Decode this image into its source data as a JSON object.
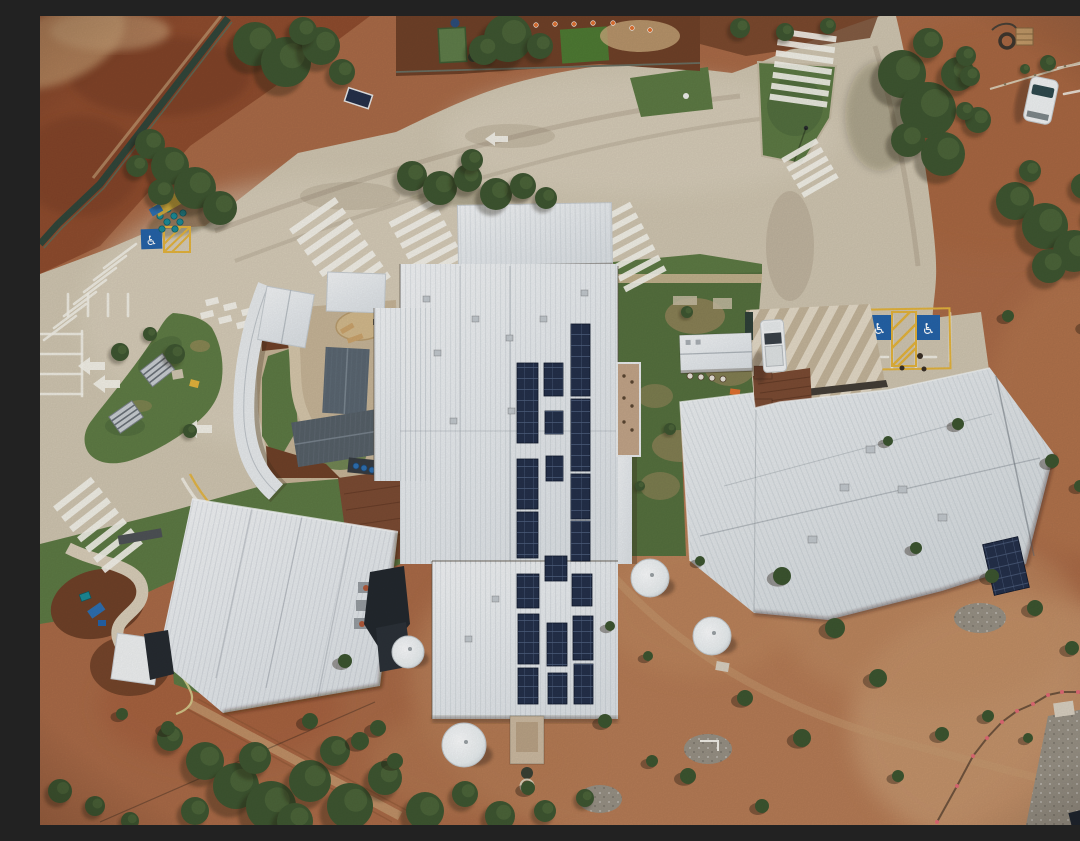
{
  "meta": {
    "alt": "Aerial top-down drone photo of a remote outback school campus: white corrugated metal roofs with rooftop solar panel arrays, a looped car park with a grass island and shade shelters, zebra crossings, accessible parking bays, water tanks, scattered trees and shrubs on red dirt ground"
  },
  "colors": {
    "dirt_base": "#a96a47",
    "dirt_dark": "#8e4c2e",
    "dirt_deep": "#7c3f25",
    "dirt_light": "#bf8a62",
    "dirt_pale": "#c89a72",
    "concrete": "#cfc5b0",
    "concrete_light": "#dbd2bf",
    "concrete_dark": "#b7ab94",
    "roof_white": "#e9ecee",
    "roof_gray": "#5a6671",
    "solar": "#24304a",
    "solar_line": "#43567a",
    "grass": "#5d7a44",
    "grass_dark": "#49633a",
    "courtyard": "#55703e",
    "courtyard_patch": "#96855b",
    "tree": "#3e5631",
    "tree_light": "#55713f",
    "mulch": "#6f4128",
    "white": "#f4f4f2",
    "yellow": "#e3b33c",
    "sign_blue": "#2563a8",
    "teal": "#1c8a96",
    "tank": "#eff2f3",
    "shadow": "#2a1c12",
    "dark_structure": "#262b31",
    "rust": "#7b4b33",
    "walk_dark": "#443e37",
    "gravel": "#979084",
    "path_tan": "#c6b497",
    "terrace": "#c3b49a",
    "car_white": "#f0f2f3",
    "glass": "#3a4148",
    "cone_orange": "#e07030",
    "flag_pink": "#e06a74"
  },
  "scene": {
    "solar_panels": [
      [
        477,
        347,
        21,
        80
      ],
      [
        477,
        443,
        21,
        50
      ],
      [
        477,
        496,
        21,
        46
      ],
      [
        477,
        558,
        22,
        34
      ],
      [
        478,
        598,
        21,
        50
      ],
      [
        478,
        652,
        20,
        36
      ],
      [
        504,
        347,
        19,
        33
      ],
      [
        505,
        395,
        18,
        23
      ],
      [
        506,
        440,
        17,
        25
      ],
      [
        505,
        540,
        22,
        25
      ],
      [
        507,
        607,
        20,
        43
      ],
      [
        508,
        657,
        19,
        31
      ],
      [
        531,
        308,
        19,
        72
      ],
      [
        531,
        383,
        19,
        72
      ],
      [
        531,
        458,
        19,
        45
      ],
      [
        531,
        505,
        19,
        40
      ],
      [
        532,
        558,
        20,
        32
      ],
      [
        533,
        600,
        20,
        44
      ],
      [
        534,
        648,
        19,
        40
      ]
    ],
    "trees": [
      [
        215,
        28,
        22
      ],
      [
        246,
        46,
        25
      ],
      [
        281,
        30,
        19
      ],
      [
        302,
        56,
        13
      ],
      [
        263,
        15,
        14
      ],
      [
        110,
        128,
        15
      ],
      [
        130,
        150,
        19
      ],
      [
        155,
        172,
        21
      ],
      [
        180,
        192,
        17
      ],
      [
        121,
        176,
        13
      ],
      [
        97,
        150,
        11
      ],
      [
        372,
        160,
        15
      ],
      [
        400,
        172,
        17
      ],
      [
        428,
        162,
        14
      ],
      [
        456,
        178,
        16
      ],
      [
        483,
        170,
        13
      ],
      [
        506,
        182,
        11
      ],
      [
        432,
        144,
        11
      ],
      [
        468,
        22,
        24
      ],
      [
        444,
        34,
        15
      ],
      [
        500,
        30,
        13
      ],
      [
        862,
        58,
        24
      ],
      [
        888,
        94,
        28
      ],
      [
        903,
        138,
        22
      ],
      [
        868,
        124,
        17
      ],
      [
        918,
        58,
        17
      ],
      [
        888,
        27,
        15
      ],
      [
        938,
        104,
        13
      ],
      [
        926,
        40,
        10
      ],
      [
        975,
        185,
        19
      ],
      [
        1005,
        210,
        23
      ],
      [
        1034,
        235,
        21
      ],
      [
        1059,
        200,
        15
      ],
      [
        1009,
        250,
        17
      ],
      [
        1044,
        170,
        13
      ],
      [
        990,
        155,
        11
      ],
      [
        1062,
        10,
        13
      ],
      [
        1075,
        34,
        11
      ],
      [
        1008,
        47,
        8
      ],
      [
        985,
        53,
        5
      ],
      [
        930,
        60,
        10
      ],
      [
        925,
        95,
        9
      ],
      [
        165,
        745,
        19
      ],
      [
        196,
        770,
        23
      ],
      [
        231,
        790,
        25
      ],
      [
        270,
        765,
        21
      ],
      [
        310,
        790,
        23
      ],
      [
        345,
        762,
        17
      ],
      [
        385,
        795,
        19
      ],
      [
        425,
        778,
        13
      ],
      [
        460,
        800,
        15
      ],
      [
        130,
        722,
        13
      ],
      [
        295,
        735,
        15
      ],
      [
        505,
        795,
        11
      ],
      [
        545,
        782,
        9
      ],
      [
        215,
        742,
        16
      ],
      [
        255,
        805,
        18
      ],
      [
        155,
        795,
        14
      ],
      [
        80,
        336,
        9
      ],
      [
        135,
        338,
        10
      ],
      [
        110,
        318,
        7
      ],
      [
        150,
        415,
        7
      ],
      [
        647,
        296,
        6
      ],
      [
        630,
        413,
        6
      ],
      [
        600,
        470,
        5
      ],
      [
        20,
        775,
        12
      ],
      [
        55,
        790,
        10
      ],
      [
        90,
        805,
        9
      ],
      [
        700,
        12,
        10
      ],
      [
        745,
        16,
        9
      ],
      [
        788,
        10,
        8
      ]
    ],
    "shrubs": [
      [
        742,
        560,
        9
      ],
      [
        795,
        612,
        10
      ],
      [
        838,
        662,
        9
      ],
      [
        705,
        682,
        8
      ],
      [
        762,
        722,
        9
      ],
      [
        648,
        760,
        8
      ],
      [
        565,
        705,
        7
      ],
      [
        612,
        745,
        6
      ],
      [
        488,
        772,
        7
      ],
      [
        305,
        645,
        7
      ],
      [
        338,
        712,
        8
      ],
      [
        128,
        712,
        7
      ],
      [
        82,
        698,
        6
      ],
      [
        995,
        592,
        8
      ],
      [
        1032,
        632,
        7
      ],
      [
        952,
        560,
        7
      ],
      [
        876,
        532,
        6
      ],
      [
        1012,
        445,
        7
      ],
      [
        918,
        408,
        6
      ],
      [
        848,
        425,
        5
      ],
      [
        968,
        300,
        6
      ],
      [
        1048,
        310,
        7
      ],
      [
        1040,
        470,
        6
      ],
      [
        902,
        718,
        7
      ],
      [
        858,
        760,
        6
      ],
      [
        722,
        790,
        7
      ],
      [
        948,
        700,
        6
      ],
      [
        988,
        722,
        5
      ],
      [
        270,
        705,
        8
      ],
      [
        320,
        725,
        9
      ],
      [
        355,
        745,
        8
      ],
      [
        660,
        545,
        5
      ],
      [
        608,
        640,
        5
      ],
      [
        570,
        610,
        5
      ]
    ],
    "zebras": [
      {
        "x": 300,
        "y": 237,
        "a": -35,
        "n": 8,
        "len": 56,
        "t": 6.5,
        "g": 13
      },
      {
        "x": 58,
        "y": 509,
        "a": -38,
        "n": 7,
        "len": 48,
        "t": 6.5,
        "g": 13
      },
      {
        "x": 389,
        "y": 229,
        "a": -28,
        "n": 7,
        "len": 50,
        "t": 6,
        "g": 12
      },
      {
        "x": 588,
        "y": 231,
        "a": -28,
        "n": 7,
        "len": 46,
        "t": 6,
        "g": 12
      },
      {
        "x": 763,
        "y": 52,
        "a": 8,
        "n": 7,
        "len": 58,
        "t": 6,
        "g": 11
      },
      {
        "x": 770,
        "y": 152,
        "a": -30,
        "n": 5,
        "len": 40,
        "t": 5.5,
        "g": 10
      }
    ],
    "white_lines": [
      [
        96,
        228,
        64,
        252
      ],
      [
        86,
        240,
        54,
        264
      ],
      [
        76,
        252,
        44,
        276
      ],
      [
        66,
        264,
        34,
        288
      ],
      [
        56,
        276,
        24,
        300
      ],
      [
        46,
        288,
        14,
        312
      ],
      [
        36,
        300,
        4,
        324
      ],
      [
        28,
        278,
        28,
        300
      ],
      [
        48,
        278,
        48,
        300
      ],
      [
        68,
        278,
        68,
        300
      ],
      [
        88,
        278,
        88,
        300
      ],
      [
        0,
        318,
        42,
        318
      ],
      [
        0,
        338,
        42,
        338
      ],
      [
        0,
        358,
        42,
        358
      ],
      [
        0,
        378,
        42,
        378
      ],
      [
        42,
        315,
        42,
        380
      ],
      [
        852,
        300,
        852,
        352
      ],
      [
        876,
        300,
        876,
        352
      ],
      [
        910,
        297,
        910,
        345
      ],
      [
        834,
        341,
        848,
        341
      ],
      [
        882,
        341,
        896,
        341
      ],
      [
        1018,
        52,
        1048,
        46
      ],
      [
        1024,
        78,
        1054,
        72
      ]
    ],
    "arrows": [
      "65,346 50,346 50,341 38,350 50,359 50,354 65,354",
      "80,364 65,364 65,359 53,368 65,377 65,372 80,372",
      "172,409 157,409 157,404 145,413 157,422 157,417 172,417",
      "468,120 455,120 455,116 445,123 455,130 455,126 468,126"
    ],
    "crossing_blocks": [
      [
        165,
        284
      ],
      [
        183,
        289
      ],
      [
        201,
        294
      ],
      [
        219,
        299
      ],
      [
        237,
        304
      ],
      [
        160,
        297
      ],
      [
        178,
        302
      ],
      [
        196,
        307
      ],
      [
        214,
        312
      ],
      [
        232,
        317
      ]
    ],
    "cones": [
      [
        496,
        9
      ],
      [
        515,
        8
      ],
      [
        534,
        8
      ],
      [
        553,
        7
      ],
      [
        573,
        7
      ],
      [
        592,
        12
      ],
      [
        610,
        14
      ],
      [
        466,
        12
      ]
    ],
    "flags": [
      [
        897,
        806
      ],
      [
        917,
        770
      ],
      [
        933,
        740
      ],
      [
        947,
        722
      ],
      [
        962,
        706
      ],
      [
        977,
        695
      ],
      [
        993,
        688
      ],
      [
        1008,
        679
      ],
      [
        1022,
        676
      ],
      [
        1038,
        676
      ],
      [
        1058,
        680
      ],
      [
        1076,
        684
      ]
    ],
    "vents_central": [
      [
        383,
        280
      ],
      [
        432,
        300
      ],
      [
        466,
        319
      ],
      [
        394,
        334
      ],
      [
        410,
        402
      ],
      [
        468,
        392
      ],
      [
        541,
        274
      ],
      [
        452,
        580
      ],
      [
        425,
        620
      ],
      [
        500,
        300
      ]
    ],
    "vents_right": [
      [
        826,
        430
      ],
      [
        858,
        470
      ],
      [
        898,
        498
      ],
      [
        768,
        520
      ],
      [
        800,
        468
      ]
    ],
    "tanks": [
      [
        610,
        562,
        19
      ],
      [
        672,
        620,
        19
      ],
      [
        424,
        729,
        22
      ],
      [
        368,
        636,
        16
      ]
    ],
    "gravel": [
      [
        560,
        783,
        22,
        14
      ],
      [
        668,
        733,
        24,
        15
      ],
      [
        940,
        602,
        26,
        15
      ]
    ],
    "tables": [
      [
        650,
        360
      ],
      [
        661,
        361
      ],
      [
        672,
        362
      ],
      [
        683,
        363
      ]
    ],
    "pads": [
      [
        633,
        280,
        24,
        9
      ],
      [
        673,
        282,
        19,
        11
      ]
    ],
    "bins_teal": [
      [
        120,
        200
      ],
      [
        127,
        206
      ],
      [
        134,
        200
      ],
      [
        128,
        193
      ],
      [
        140,
        206
      ],
      [
        135,
        213
      ],
      [
        122,
        213
      ],
      [
        143,
        197
      ]
    ],
    "bins_blue": [
      [
        316,
        450
      ],
      [
        324,
        452
      ],
      [
        332,
        454
      ],
      [
        340,
        456
      ],
      [
        348,
        458
      ]
    ]
  }
}
